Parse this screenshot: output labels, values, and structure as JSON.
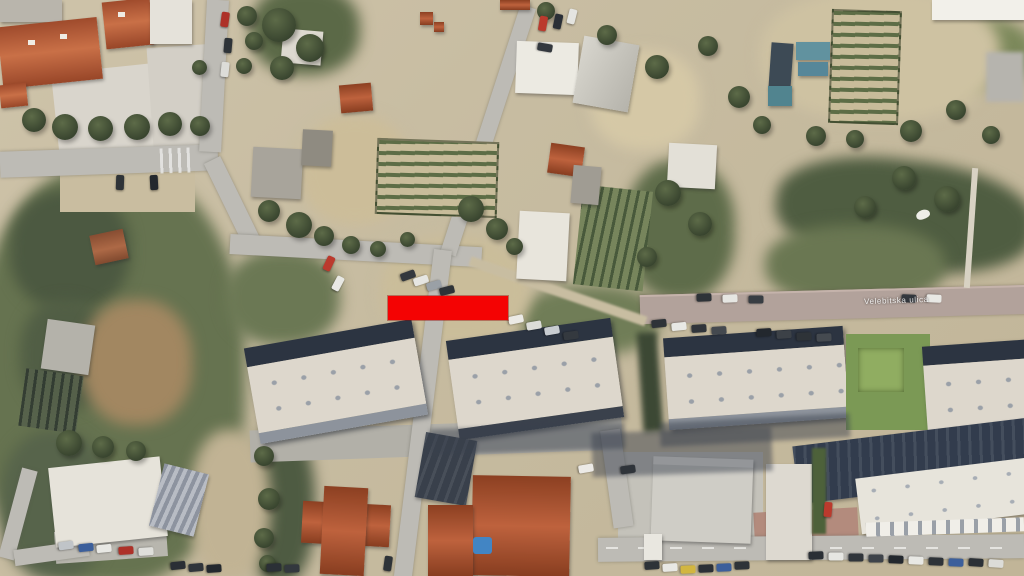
{
  "scene": {
    "description": "Satellite aerial view of a residential neighborhood with a red rectangular highlight marker over a street area",
    "street_label": "Velebitska ulica",
    "marker": {
      "shape": "rectangle",
      "color": "#fe0000",
      "x": 388,
      "y": 296,
      "width": 120,
      "height": 24
    },
    "palette": {
      "ground": "#c9bda1",
      "vegetation": "#55624a",
      "road": "#bdbbb5",
      "paved_street": "#b3a29a",
      "red_roof": "#b05028",
      "white_roof": "#ddd7cb",
      "building_shadow": "#2c3442",
      "pool": "#3f86c8"
    }
  }
}
